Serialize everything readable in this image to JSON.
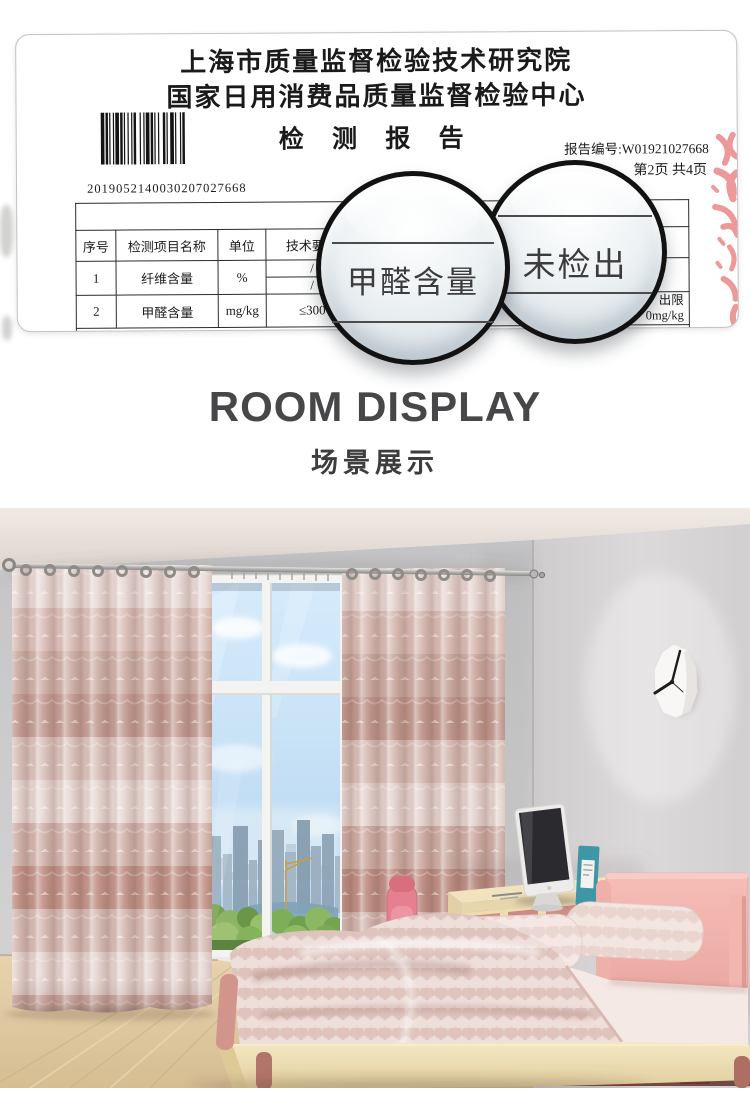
{
  "report": {
    "institute_line1": "上海市质量监督检验技术研究院",
    "institute_line2": "国家日用消费品质量监督检验中心",
    "title": "检 测 报 告",
    "report_no": "报告编号:W01921027668",
    "page_info": "第2页  共4页",
    "barcode_number": "2019052140030207027668",
    "table": {
      "headers": {
        "no": "序号",
        "item": "检测项目名称",
        "unit": "单位",
        "requirement": "技术要求"
      },
      "rows": [
        {
          "no": "1",
          "item": "纤维含量",
          "unit": "%",
          "req_a": "/",
          "req_b": "/"
        },
        {
          "no": "2",
          "item": "甲醛含量",
          "unit": "mg/kg",
          "req": "≤300"
        }
      ],
      "partial_right_line1": "出限",
      "partial_right_line2": "0mg/kg"
    },
    "magnifier_left": "甲醛含量",
    "magnifier_right": "未检出"
  },
  "section": {
    "title_en": "ROOM DISPLAY",
    "title_cn": "场景展示"
  },
  "colors": {
    "heading_gray": "#47474a",
    "stamp_red": "#e25c5c",
    "curtain_pink": "#d9bcb4",
    "headboard_pink": "#f3b7b1",
    "wall_gray": "#cecdd0",
    "bed_wood": "#eddfb6",
    "sky_blue": "#c3ddf3"
  }
}
